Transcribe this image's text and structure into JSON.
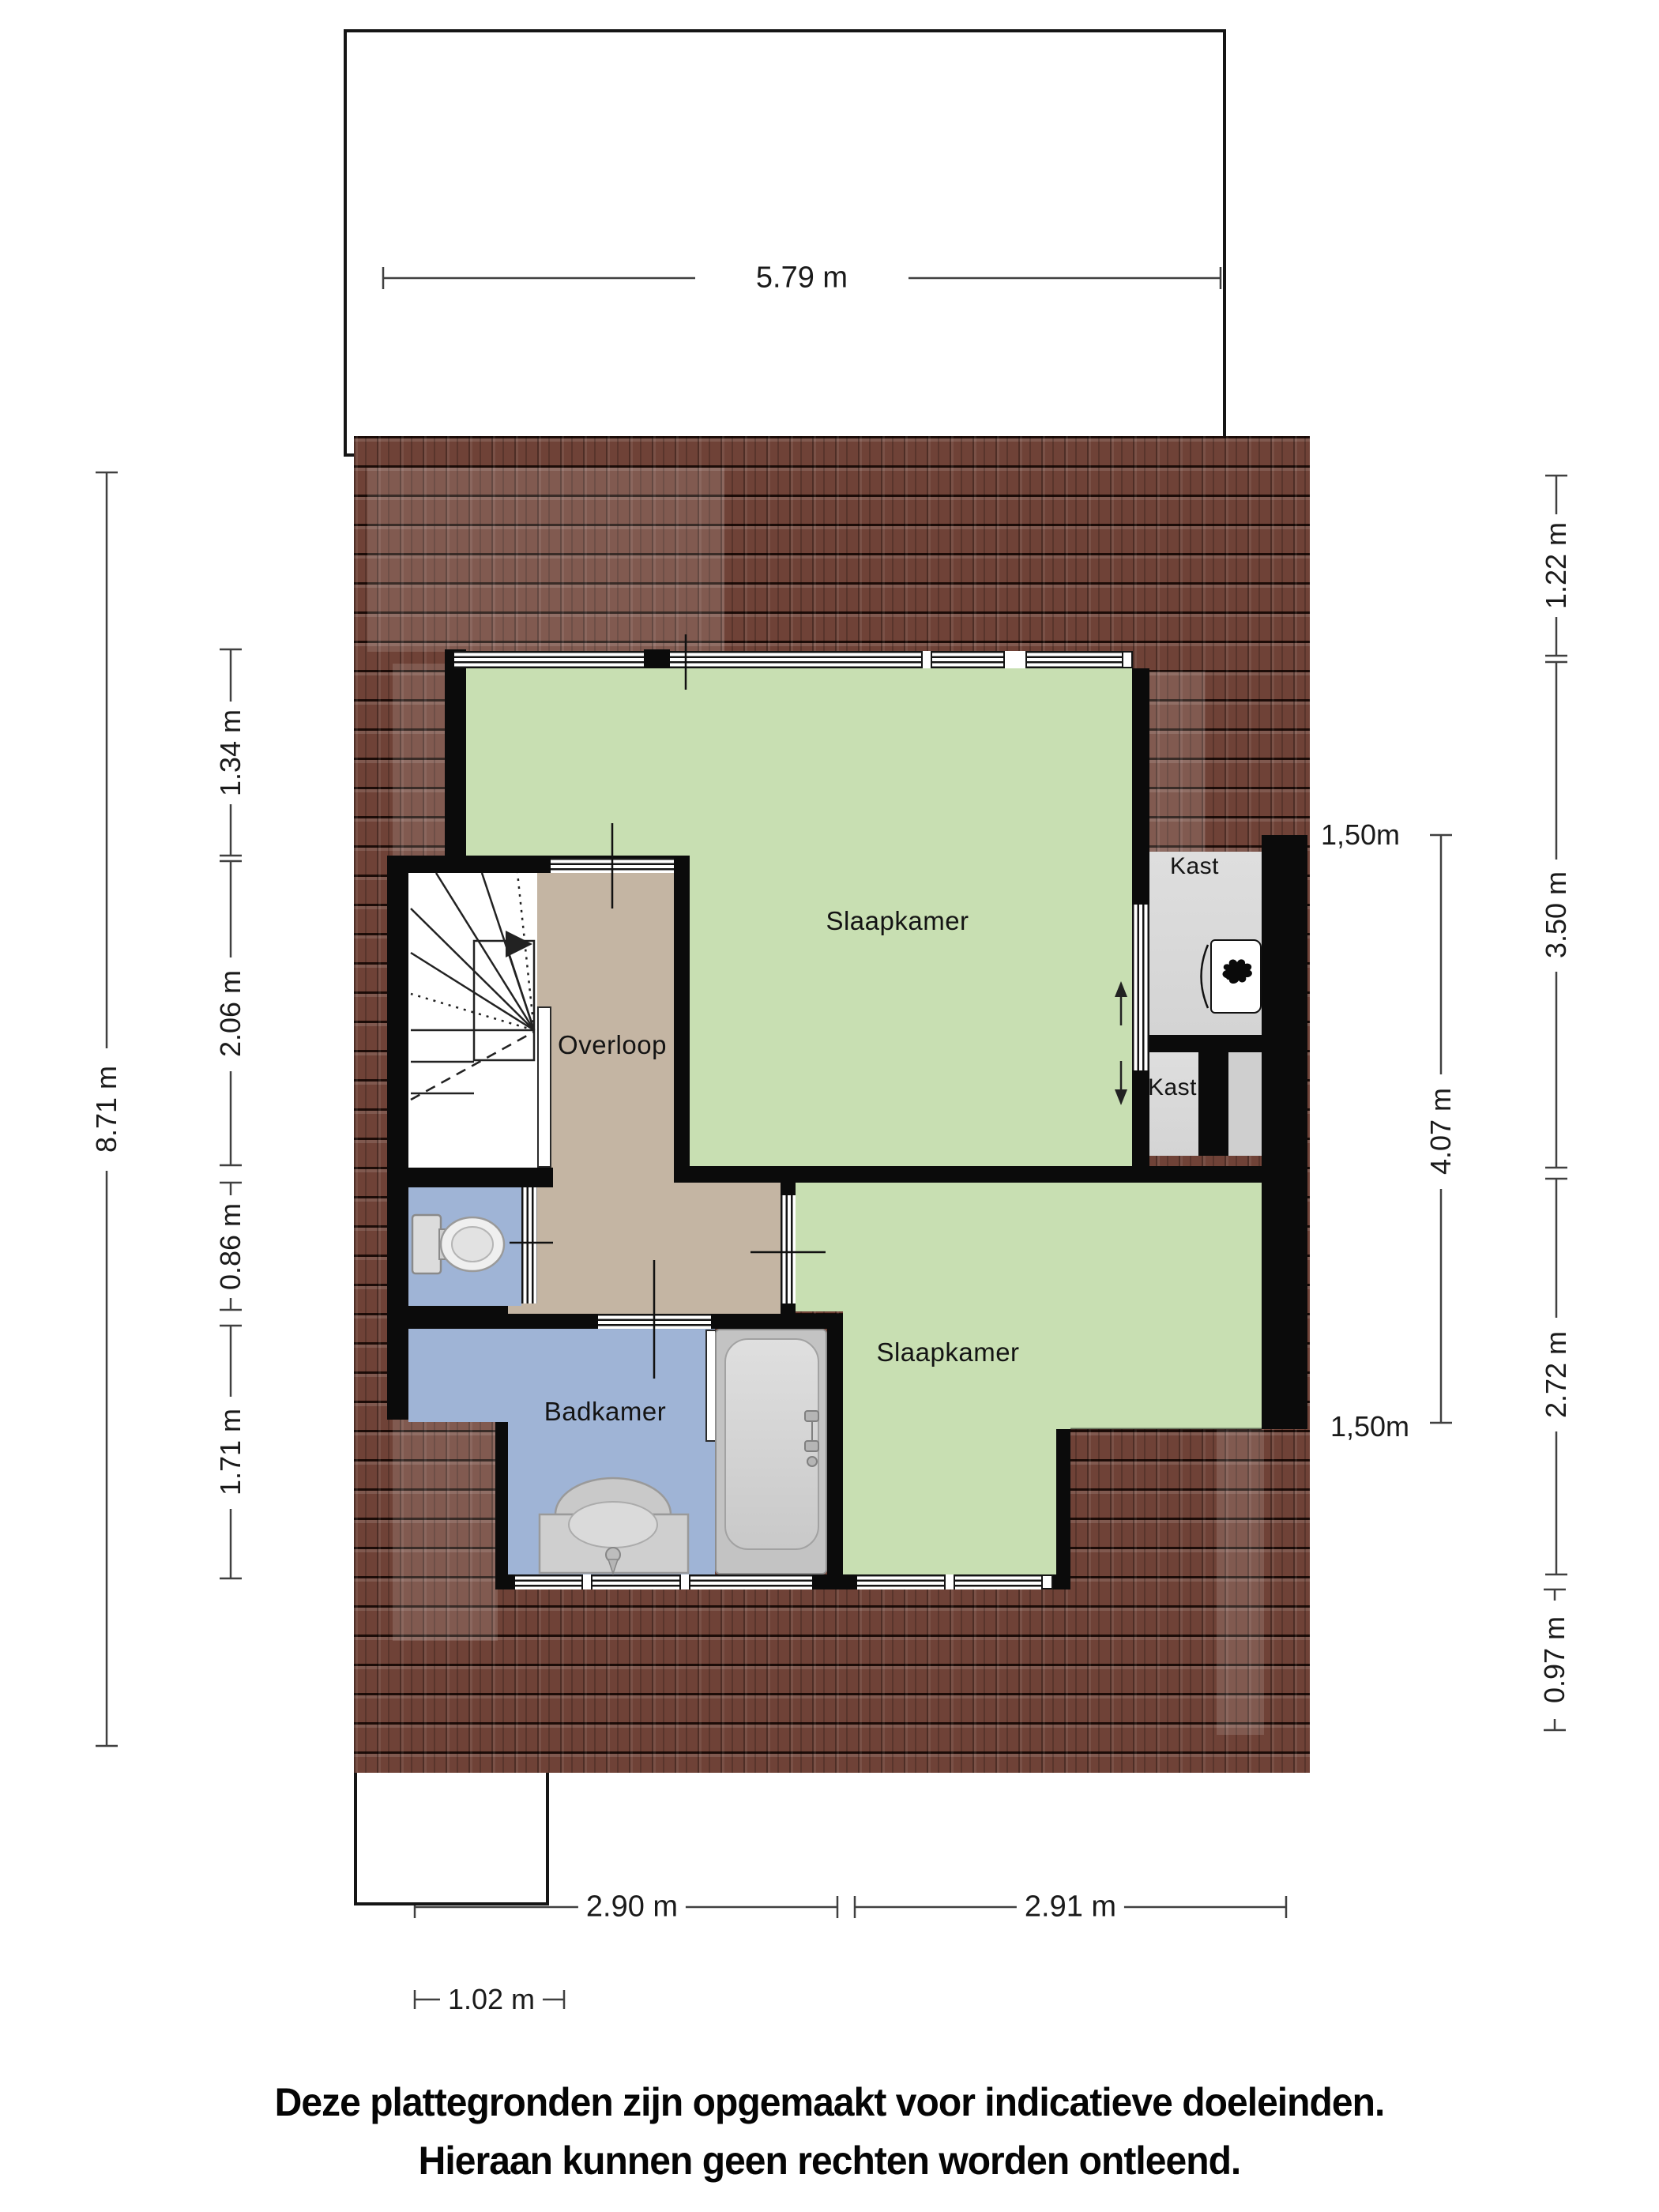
{
  "rooms": {
    "bedroom_top": "Slaapkamer",
    "bedroom_bottom": "Slaapkamer",
    "landing": "Overloop",
    "bathroom": "Badkamer",
    "closet_top": "Kast",
    "closet_bottom": "Kast"
  },
  "dimensions": {
    "top_width": "5.79 m",
    "left_outer": "8.71 m",
    "left_inner": [
      "1.34 m",
      "2.06 m",
      "0.86 m",
      "1.71 m"
    ],
    "right_inner": "4.07 m",
    "right_knee_top": "1,50m",
    "right_knee_bottom": "1,50m",
    "right_outer": [
      "1.22 m",
      "3.50 m",
      "2.72 m",
      "0.97 m"
    ],
    "bottom_left": "2.90 m",
    "bottom_right": "2.91 m",
    "bottom_offset": "1.02 m"
  },
  "disclaimer": {
    "line1": "Deze plattegronden zijn opgemaakt voor indicatieve doeleinden.",
    "line2": "Hieraan kunnen geen rechten worden ontleend."
  },
  "colors": {
    "bedroom": "#c8dfb2",
    "landing": "#c4b5a3",
    "bathroom": "#9fb4d6",
    "closet": "#dcdcdc",
    "roof": "#6f4237",
    "wall": "#0b0b0b"
  }
}
